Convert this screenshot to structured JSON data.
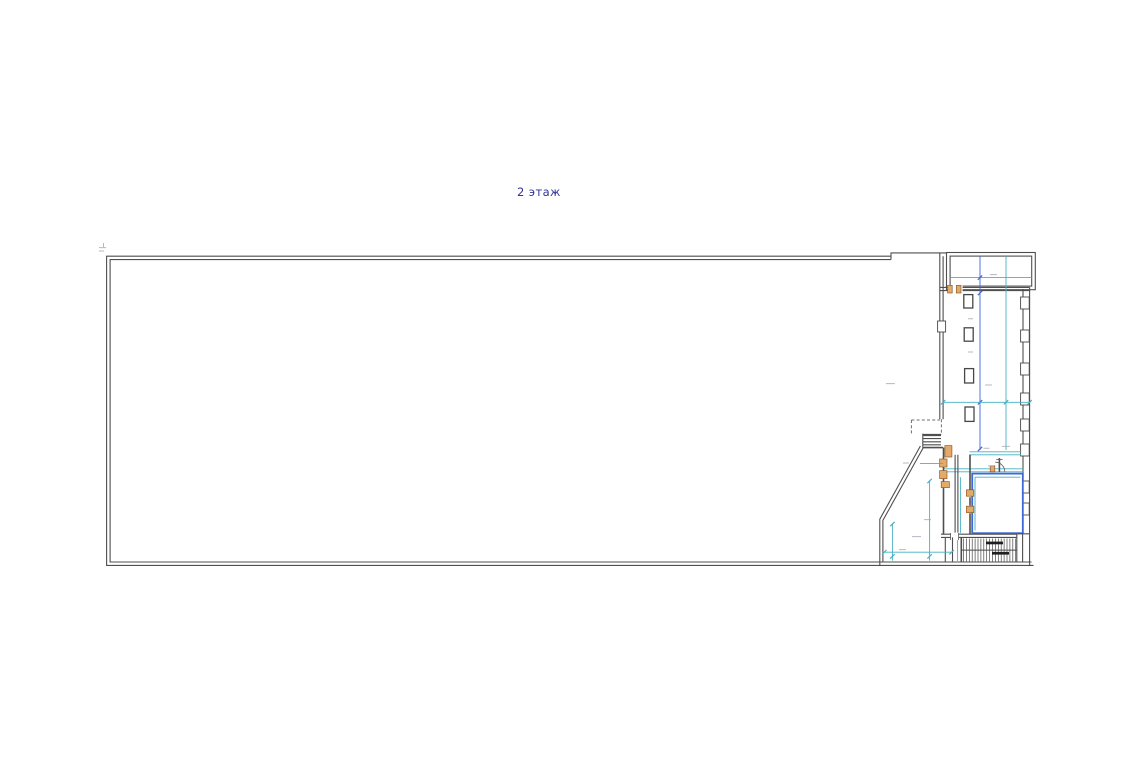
{
  "page": {
    "background": "#ffffff"
  },
  "plan": {
    "floor_label": "2 этаж"
  },
  "colors": {
    "bg": "#ffffff",
    "label": "#33339b",
    "wall": "#4f4f4f",
    "wall-soft": "#6e6e6e",
    "cyan": "#45b0c4",
    "blue": "#3f68d6",
    "tan": "#e3aa69",
    "tan-dark": "#8f5a28",
    "hatch": "#3c3c3c",
    "dim-mark": "#9aa0b0"
  }
}
